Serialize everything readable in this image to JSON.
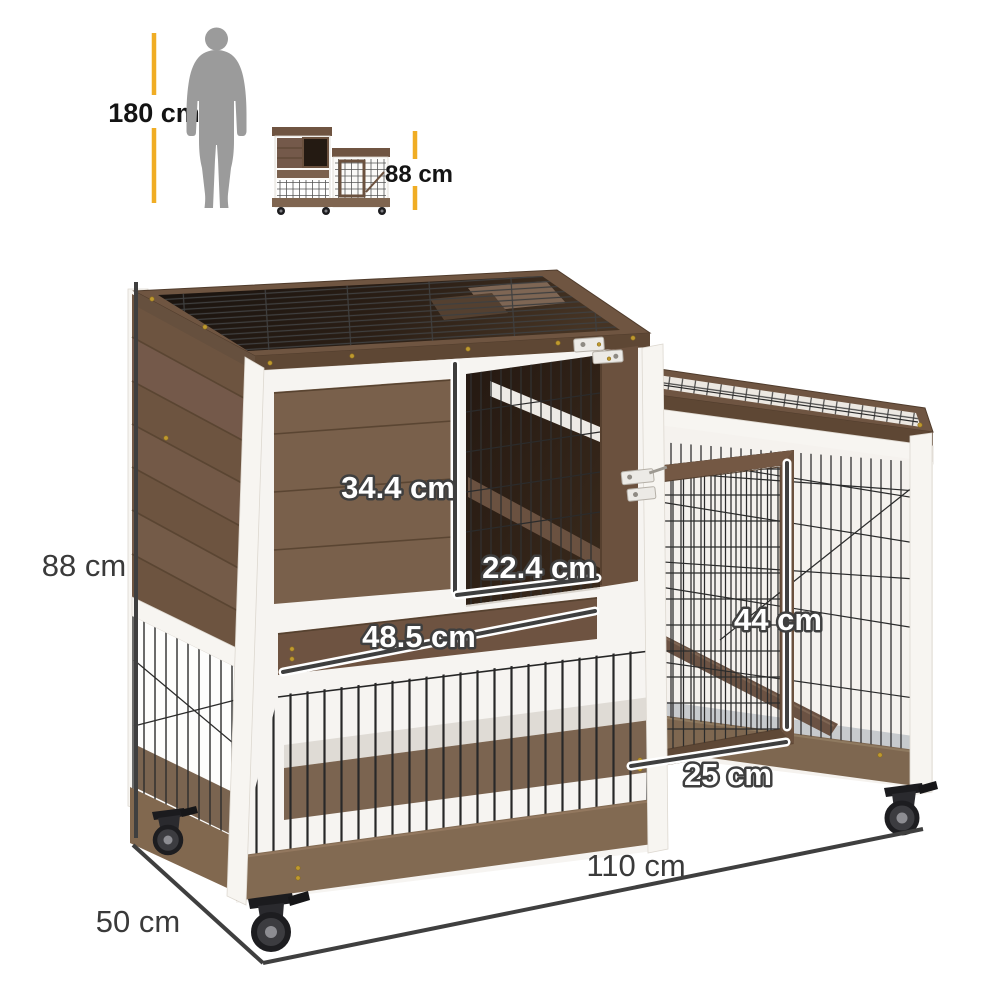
{
  "reference": {
    "human_height": "180 cm",
    "product_height": "88 cm"
  },
  "dimensions": {
    "height": "88 cm",
    "depth": "50 cm",
    "width": "110 cm",
    "upper_door_height": "34.4 cm",
    "upper_door_width": "22.4 cm",
    "board_length": "48.5 cm",
    "right_door_height": "44 cm",
    "right_door_width": "25 cm"
  },
  "colors": {
    "background": "#FFFFFF",
    "accent_yellow": "#F0AD24",
    "dimension_line": "#3F3F3F",
    "label_dark": "#141414",
    "label_gray": "#3A3A3A",
    "overlay_text": "#FFFFFF",
    "silhouette_gray": "#9B9B9B",
    "wood_brown": "#74594A",
    "wood_dark": "#5E4734",
    "trim_white": "#F7F5F1",
    "mesh_wire": "#2B2B2B"
  }
}
